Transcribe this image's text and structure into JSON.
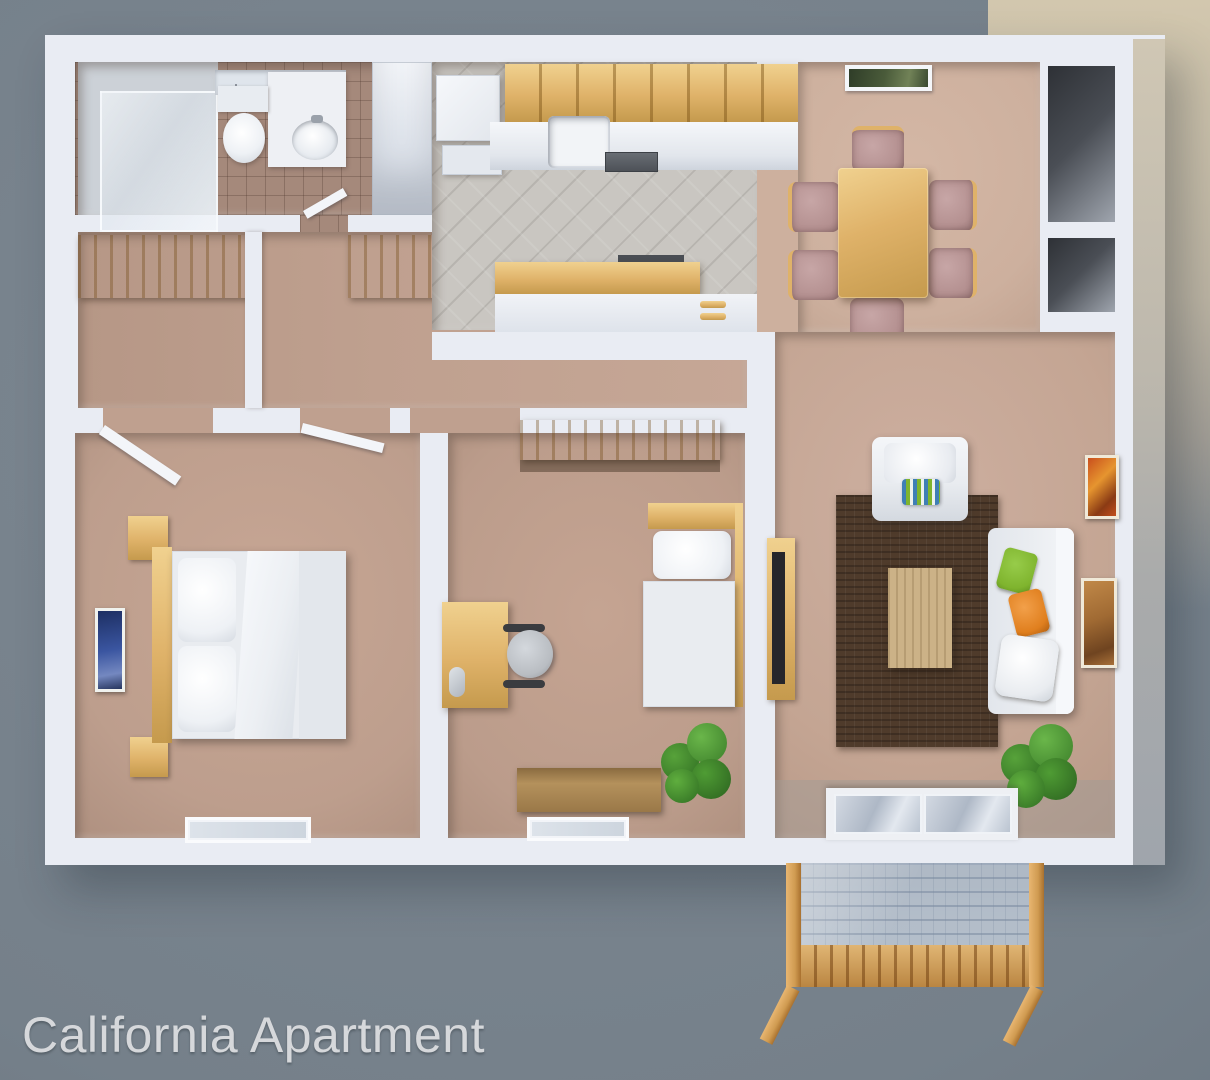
{
  "caption": {
    "text": "California Apartment"
  },
  "scene": {
    "type": "3d-floor-plan-render",
    "rooms": [
      "bathroom",
      "hall-with-closets",
      "kitchen",
      "dining-area",
      "living-room",
      "master-bedroom",
      "second-bedroom",
      "balcony"
    ],
    "furniture": [
      "shower",
      "toilet",
      "vanity-sink",
      "refrigerator",
      "kitchen-cabinets",
      "kitchen-sink",
      "stove",
      "peninsula-counter",
      "dining-table",
      "six-dining-chairs",
      "wall-picture",
      "armchair",
      "area-rug",
      "coffee-table",
      "sofa",
      "tv-console",
      "potted-plants",
      "double-bed",
      "nightstands",
      "twin-bed",
      "desk",
      "office-chair",
      "storage-chest",
      "sliding-glass-door",
      "wood-balcony"
    ]
  },
  "colors": {
    "bg": "#76818b",
    "bg_corner": "#d2c7ae",
    "wall": "#e9ecf3",
    "wall_shade": "#d5dae4",
    "carpet_hall": "#bfa08f",
    "carpet_master": "#bd9e8d",
    "carpet_bed2": "#bb9c8b",
    "carpet_living": "#c4a593",
    "carpet_dining": "#cdb09e",
    "tile_kitchen": "#c9c6c1",
    "tile_bath": "#a5897b",
    "wood_main": "#dfb269",
    "wood_dark": "#c59a4d",
    "wood_light": "#f0d18f",
    "rug": "#4f3b2b",
    "coffee": "#ccb287",
    "white_soft": "#eef0f4",
    "sofa": "#e9ecf0",
    "plant": "#3c7f2a",
    "pillow_green": "#7fb42e",
    "pillow_orange": "#e07f1e",
    "rose": "#b49090",
    "glass": "#c3cdd9",
    "mesh_line": "#8fa0b5",
    "balcony_wood": "#d09b51",
    "dark_recess": "#34373d",
    "tv": "#26262b",
    "art_blue": "#3a55a0",
    "art_orange": "#c94f1d",
    "art_autumn": "#a06a33",
    "art_landscape": "#4a5b3a",
    "text": "#d6d8db"
  }
}
